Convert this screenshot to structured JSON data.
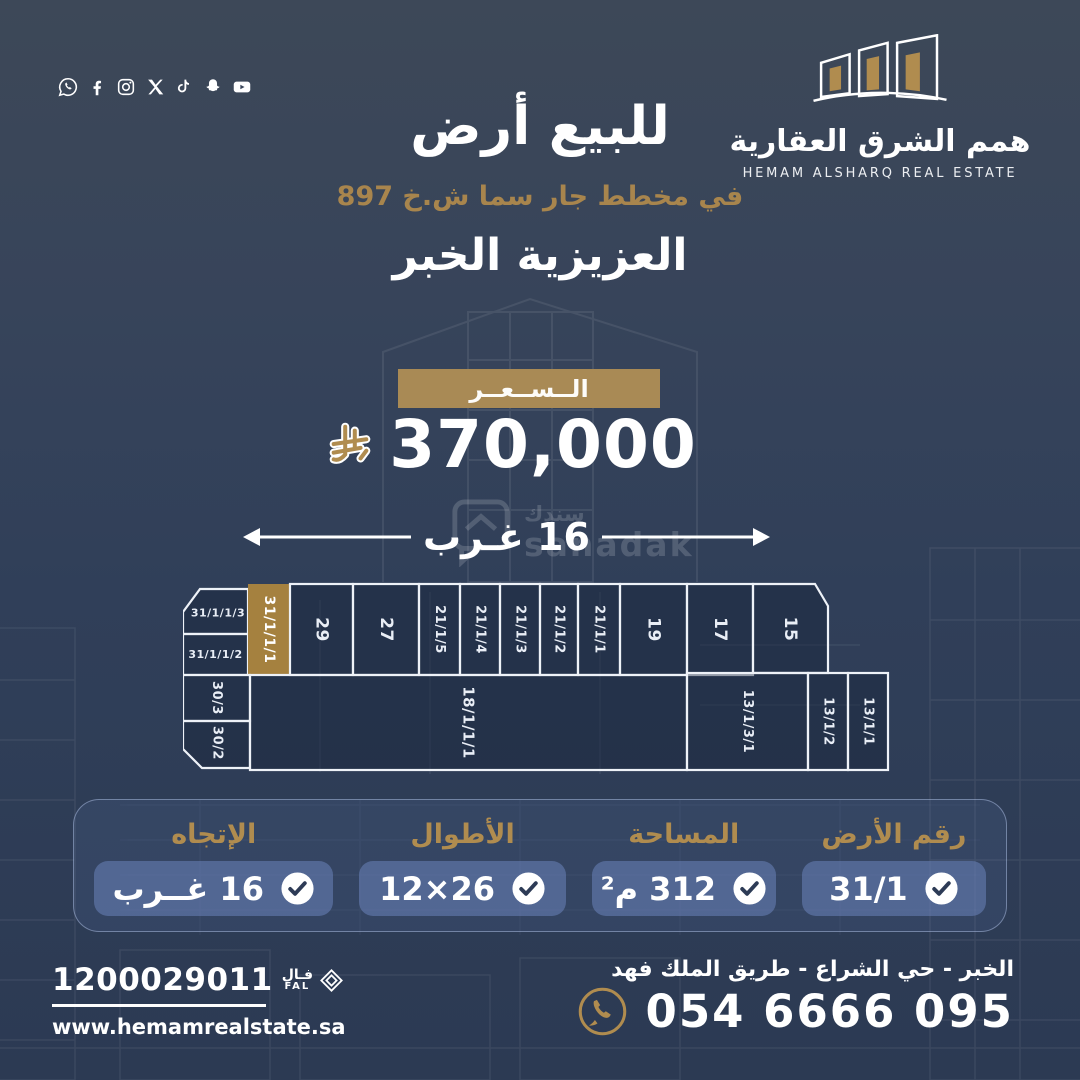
{
  "colors": {
    "background_top": "#3d4858",
    "background_bottom": "#2c3a53",
    "gold": "#b08c4f",
    "gold_band": "#a98a55",
    "plot_gold": "#a5813f",
    "navy_check": "#2d3b56",
    "pill_blue": "#6d87c0"
  },
  "social": {
    "icons": [
      "whatsapp",
      "facebook",
      "instagram",
      "x",
      "tiktok",
      "snapchat",
      "youtube"
    ]
  },
  "brand": {
    "logo_icon": "buildings-logo",
    "name_ar": "همم الشرق العقارية",
    "name_en": "HEMAM ALSHARQ REAL ESTATE"
  },
  "header": {
    "title": "للبيع أرض",
    "plan_line": "في مخطط جار سما ش.خ 897",
    "area_line": "العزيزية الخبر"
  },
  "price": {
    "label": "الــســعــر",
    "currency_icon": "saudi-riyal-symbol",
    "value": "370,000"
  },
  "frontage": {
    "label": "16 غـرب"
  },
  "watermark": {
    "ar": "سندك",
    "en": "sanadak"
  },
  "map": {
    "plots": [
      {
        "label": "31/1/1/3",
        "points": "17,7 65,7 65,52 0,52 0,30",
        "orient": "h",
        "fs": 11,
        "lx": 35,
        "ly": 31
      },
      {
        "label": "31/1/1/2",
        "rect": [
          0,
          52,
          65,
          41
        ],
        "orient": "h",
        "fs": 11
      },
      {
        "label": "31/1/1/1",
        "rect": [
          65,
          2,
          42,
          91
        ],
        "orient": "v",
        "gold": true,
        "fs": 14
      },
      {
        "label": "29",
        "rect": [
          107,
          2,
          63,
          91
        ],
        "orient": "v",
        "fs": 17
      },
      {
        "label": "27",
        "rect": [
          170,
          2,
          66,
          91
        ],
        "orient": "v",
        "fs": 17
      },
      {
        "label": "21/1/5",
        "rect": [
          236,
          2,
          41,
          91
        ],
        "orient": "v",
        "fs": 13
      },
      {
        "label": "21/1/4",
        "rect": [
          277,
          2,
          40,
          91
        ],
        "orient": "v",
        "fs": 13
      },
      {
        "label": "21/1/3",
        "rect": [
          317,
          2,
          40,
          91
        ],
        "orient": "v",
        "fs": 13
      },
      {
        "label": "21/1/2",
        "rect": [
          357,
          2,
          38,
          91
        ],
        "orient": "v",
        "fs": 13
      },
      {
        "label": "21/1/1",
        "rect": [
          395,
          2,
          42,
          91
        ],
        "orient": "v",
        "fs": 13
      },
      {
        "label": "19",
        "rect": [
          437,
          2,
          67,
          91
        ],
        "orient": "v",
        "fs": 17
      },
      {
        "label": "17",
        "rect": [
          504,
          2,
          66,
          91
        ],
        "orient": "v",
        "fs": 17
      },
      {
        "label": "15",
        "points": "570,2 632,2 645,24 645,91 570,91",
        "orient": "v",
        "fs": 17,
        "lx": 607,
        "ly": 47
      },
      {
        "label": "30/3",
        "rect": [
          0,
          93,
          67,
          46
        ],
        "orient": "v",
        "fs": 13
      },
      {
        "label": "30/2",
        "points": "0,139 67,139 67,186 19,186 0,167",
        "orient": "v",
        "fs": 13,
        "lx": 34,
        "ly": 161
      },
      {
        "label": "18/1/1/1",
        "rect": [
          67,
          93,
          437,
          95
        ],
        "orient": "v",
        "fs": 15
      },
      {
        "label": "13/1/3/1",
        "rect": [
          504,
          91,
          121,
          97
        ],
        "orient": "v",
        "fs": 13
      },
      {
        "label": "13/1/2",
        "rect": [
          625,
          91,
          40,
          97
        ],
        "orient": "v",
        "fs": 13
      },
      {
        "label": "13/1/1",
        "rect": [
          665,
          91,
          40,
          97
        ],
        "orient": "v",
        "fs": 13
      }
    ]
  },
  "details": {
    "items": [
      {
        "id": "plot-number",
        "label": "رقم الأرض",
        "value": "31/1"
      },
      {
        "id": "area",
        "label": "المساحة",
        "value": "312 م²"
      },
      {
        "id": "dimensions",
        "label": "الأطوال",
        "value": "26×12"
      },
      {
        "id": "direction",
        "label": "الإتجاه",
        "value": "16 غــرب"
      }
    ]
  },
  "footer": {
    "unified_number": "1200029011",
    "fal_ar": "فـال",
    "fal_en": "FAL",
    "website": "www.hemamrealstate.sa",
    "address": "الخبر - حي الشراع - طريق الملك فهد",
    "whatsapp_number": "054 6666 095"
  }
}
